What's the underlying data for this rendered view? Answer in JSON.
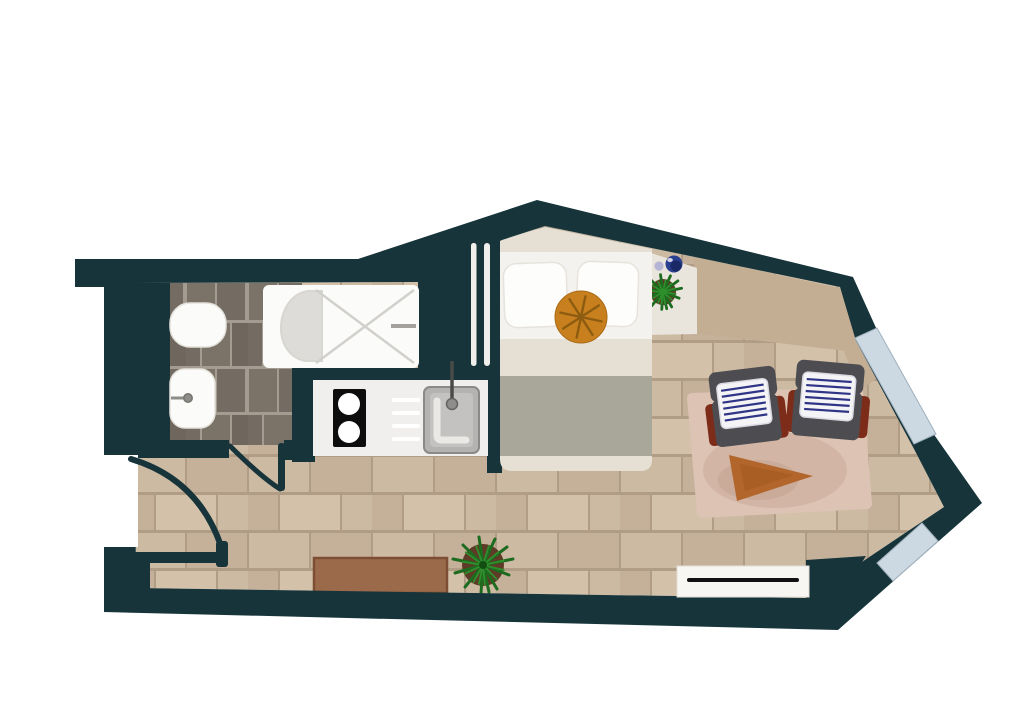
{
  "plan": {
    "type": "studio-apartment-floor-plan",
    "elements": [
      "exterior-walls",
      "entry-door",
      "bathroom-door",
      "bathroom-tiled-floor",
      "toilet",
      "washbasin",
      "bathtub-shower",
      "kitchen-counter",
      "cooktop",
      "kitchen-sink",
      "wall-slats",
      "bed",
      "pillows",
      "round-ottoman",
      "bedside-shelf",
      "shelf-plant",
      "decor-spheres",
      "wardrobe-top",
      "area-rug",
      "armchairs",
      "side-table",
      "doormat",
      "floor-plant",
      "radiator",
      "windows",
      "wood-plank-floor"
    ]
  },
  "counts": {
    "windows": 2,
    "doors": 2,
    "armchairs": 2,
    "pillows": 2,
    "cooktop_burners": 2,
    "plants": 2,
    "decor_spheres": 2
  },
  "colors": {
    "background": "#ffffff",
    "wall": "#16343a",
    "floor_brick": "#cdbaa2",
    "floor_brick_alt": "#c5b19a",
    "floor_brick_light": "#d3c1aa",
    "floor_grout": "#b19d85",
    "bath_tile": "#7b7268",
    "bath_tile_alt": "#746b62",
    "bath_tile_dark": "#6f665e",
    "bath_grout": "#a59c91",
    "fixture_white": "#fbfbf9",
    "shower_line": "#d2d0cc",
    "tub_shade": "#dedcd8",
    "counter": "#f0efed",
    "stove_black": "#0d0d0d",
    "burner_white": "#ffffff",
    "sink_outer": "#b4b3b1",
    "sink_inner": "#c3c2c0",
    "faucet_gray": "#8e8d8b",
    "bed_base": "#e6dfd3",
    "bed_sheet": "#f4f2ee",
    "bed_sage": "#a8a79a",
    "pillow": "#fdfdfb",
    "ottoman_orange": "#c8801f",
    "ottoman_line": "#8d5c10",
    "shelf_cream": "#e9e5dd",
    "wardrobe_tan": "#c3ae93",
    "rug_pink": "#dcc3b4",
    "rug_shade": "#c8a795",
    "chair_gray": "#4d4c50",
    "chair_red": "#7e2c1a",
    "cushion_white": "#f4f4f6",
    "cushion_stripe": "#2f3586",
    "table_wood": "#b2662b",
    "table_wood_dark": "#a4591f",
    "mat_brown": "#9a6a4b",
    "mat_edge": "#7d4e33",
    "radiator_white": "#f8f6f2",
    "radiator_line": "#111111",
    "plant_green": "#2e8f2c",
    "plant_dark": "#1d6b1f",
    "pot_brown": "#5e3a27",
    "sphere_navy": "#2a3f8f",
    "sphere_navy_dark": "#18245e",
    "sphere_lavender": "#b6b4d4",
    "window_blue": "#ccd8e2",
    "slat_white": "#f1efec"
  }
}
